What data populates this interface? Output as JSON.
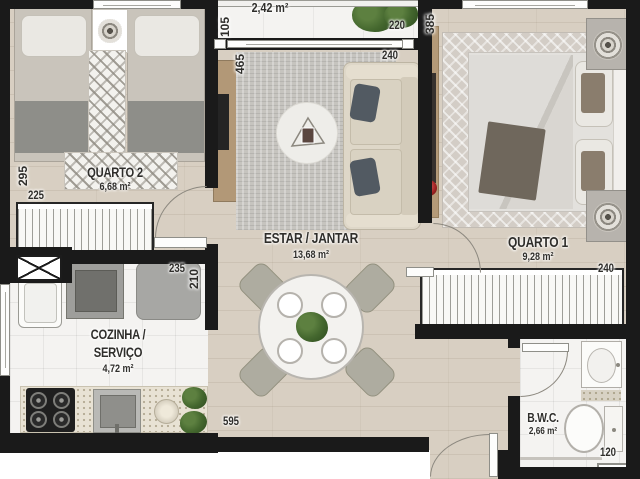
{
  "colors": {
    "wall": "#1a1a1a",
    "wood": "#d8cfc2",
    "tile": "#f4f3f1",
    "text": "#2f2e2b",
    "green": "#44672e",
    "red": "#9e2222"
  },
  "rooms": {
    "varanda": {
      "area": "2,42 m²"
    },
    "quarto2": {
      "name": "QUARTO 2",
      "area": "6,68 m²"
    },
    "estar": {
      "name": "ESTAR / JANTAR",
      "area": "13,68 m²"
    },
    "quarto1": {
      "name": "QUARTO 1",
      "area": "9,28 m²"
    },
    "cozinha": {
      "name_line1": "COZINHA /",
      "name_line2": "SERVIÇO",
      "area": "4,72 m²"
    },
    "bwc": {
      "name": "B.W.C.",
      "area": "2,66 m²"
    }
  },
  "dims": {
    "varanda_depth": "105",
    "varanda_width": "220",
    "quarto1_depth": "385",
    "estar_depth": "465",
    "estar_width": "240",
    "quarto2_depth": "295",
    "quarto2_width": "225",
    "cozinha_width": "235",
    "cozinha_depth": "210",
    "total_width": "595",
    "quarto1_width": "240",
    "bwc_width": "120"
  }
}
